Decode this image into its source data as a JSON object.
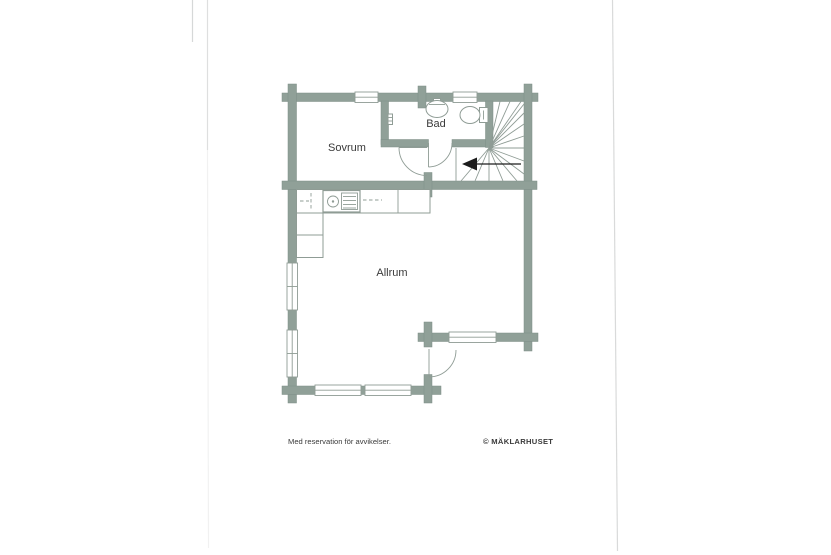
{
  "document": {
    "type": "scanned-floorplan-page",
    "footer": {
      "disclaimer": "Med reservation för avvikelser.",
      "copyright": "© MÄKLARHUSET"
    }
  },
  "floorplan": {
    "rooms": [
      {
        "label": "Sovrum"
      },
      {
        "label": "Bad"
      },
      {
        "label": "Allrum"
      }
    ],
    "features": [
      "staircase-winder",
      "direction-arrow",
      "kitchen-counter",
      "kitchen-sink",
      "bathroom-sink",
      "toilet",
      "entrance-door",
      "bathroom-door",
      "hall-door",
      "windows-7",
      "log-corner-stubs"
    ]
  },
  "colors": {
    "paper": "#ffffff",
    "wall": "#90a098",
    "wall_edge": "#7d8d86",
    "line": "#8f9c95",
    "ink": "#3a3a3a",
    "arrow": "#1c1c1c"
  }
}
